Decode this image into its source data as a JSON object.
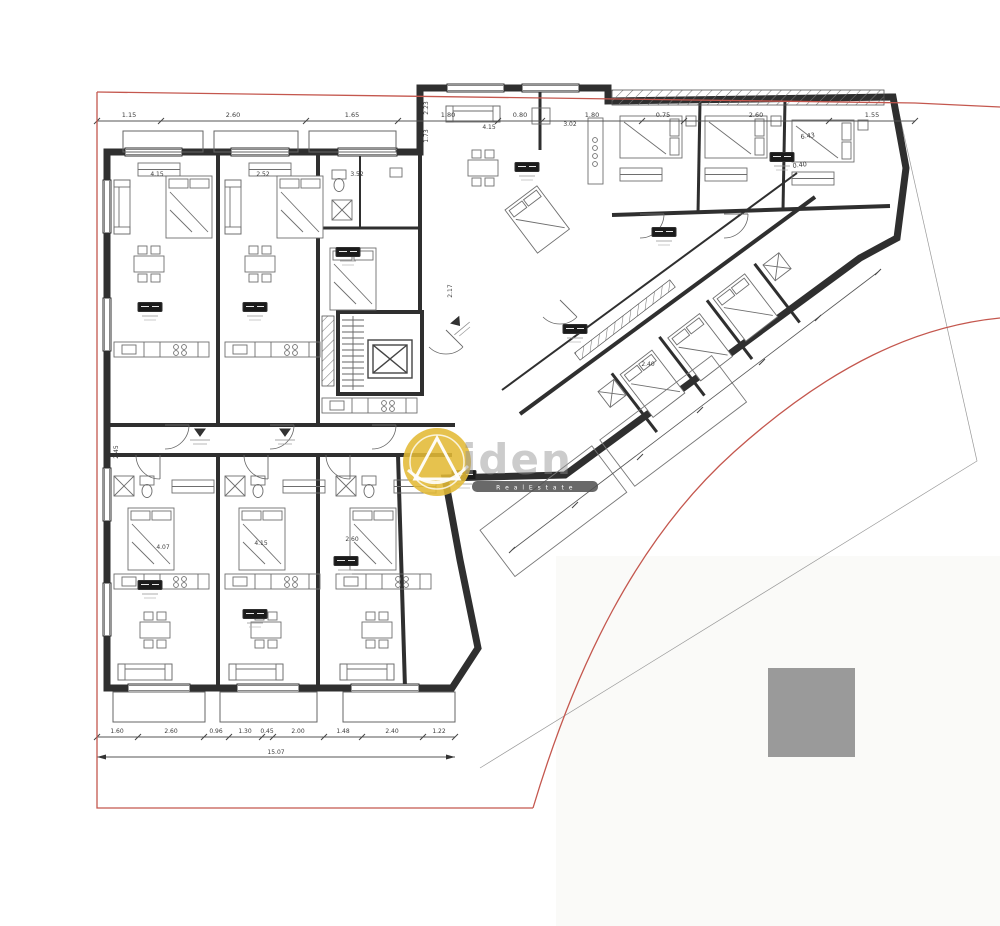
{
  "parcel": {
    "boundary_color": "#c4574e"
  },
  "building": {
    "wall_color": "#2f2f2f"
  },
  "site": {
    "gray_block_color": "#9a9a9a"
  },
  "watermark": {
    "brand_fragment": "iden",
    "tagline": "R e a l   E s t a t e",
    "logo_color": "#e2ba35",
    "bar_color": "#4f4f4f",
    "text_color": "#8f8f8f"
  },
  "dimensions": {
    "top": [
      "1.15",
      "2.60",
      "1.65",
      "1.80",
      "0.80",
      "1.80",
      "0.75",
      "2.60",
      "1.55"
    ],
    "bottom": [
      "1.60",
      "2.60",
      "0.96",
      "1.30",
      "0.45",
      "2.00",
      "1.48",
      "2.40",
      "1.22"
    ],
    "bottom_total": "15.07",
    "diagonal": [
      "6.43",
      "0.40"
    ],
    "interior": [
      "4.15",
      "2.52",
      "3.52",
      "4.15",
      "3.02",
      "2.17",
      "2.23",
      "1.73",
      "2.40",
      "2.45",
      "4.07",
      "4.15",
      "2.60"
    ]
  }
}
